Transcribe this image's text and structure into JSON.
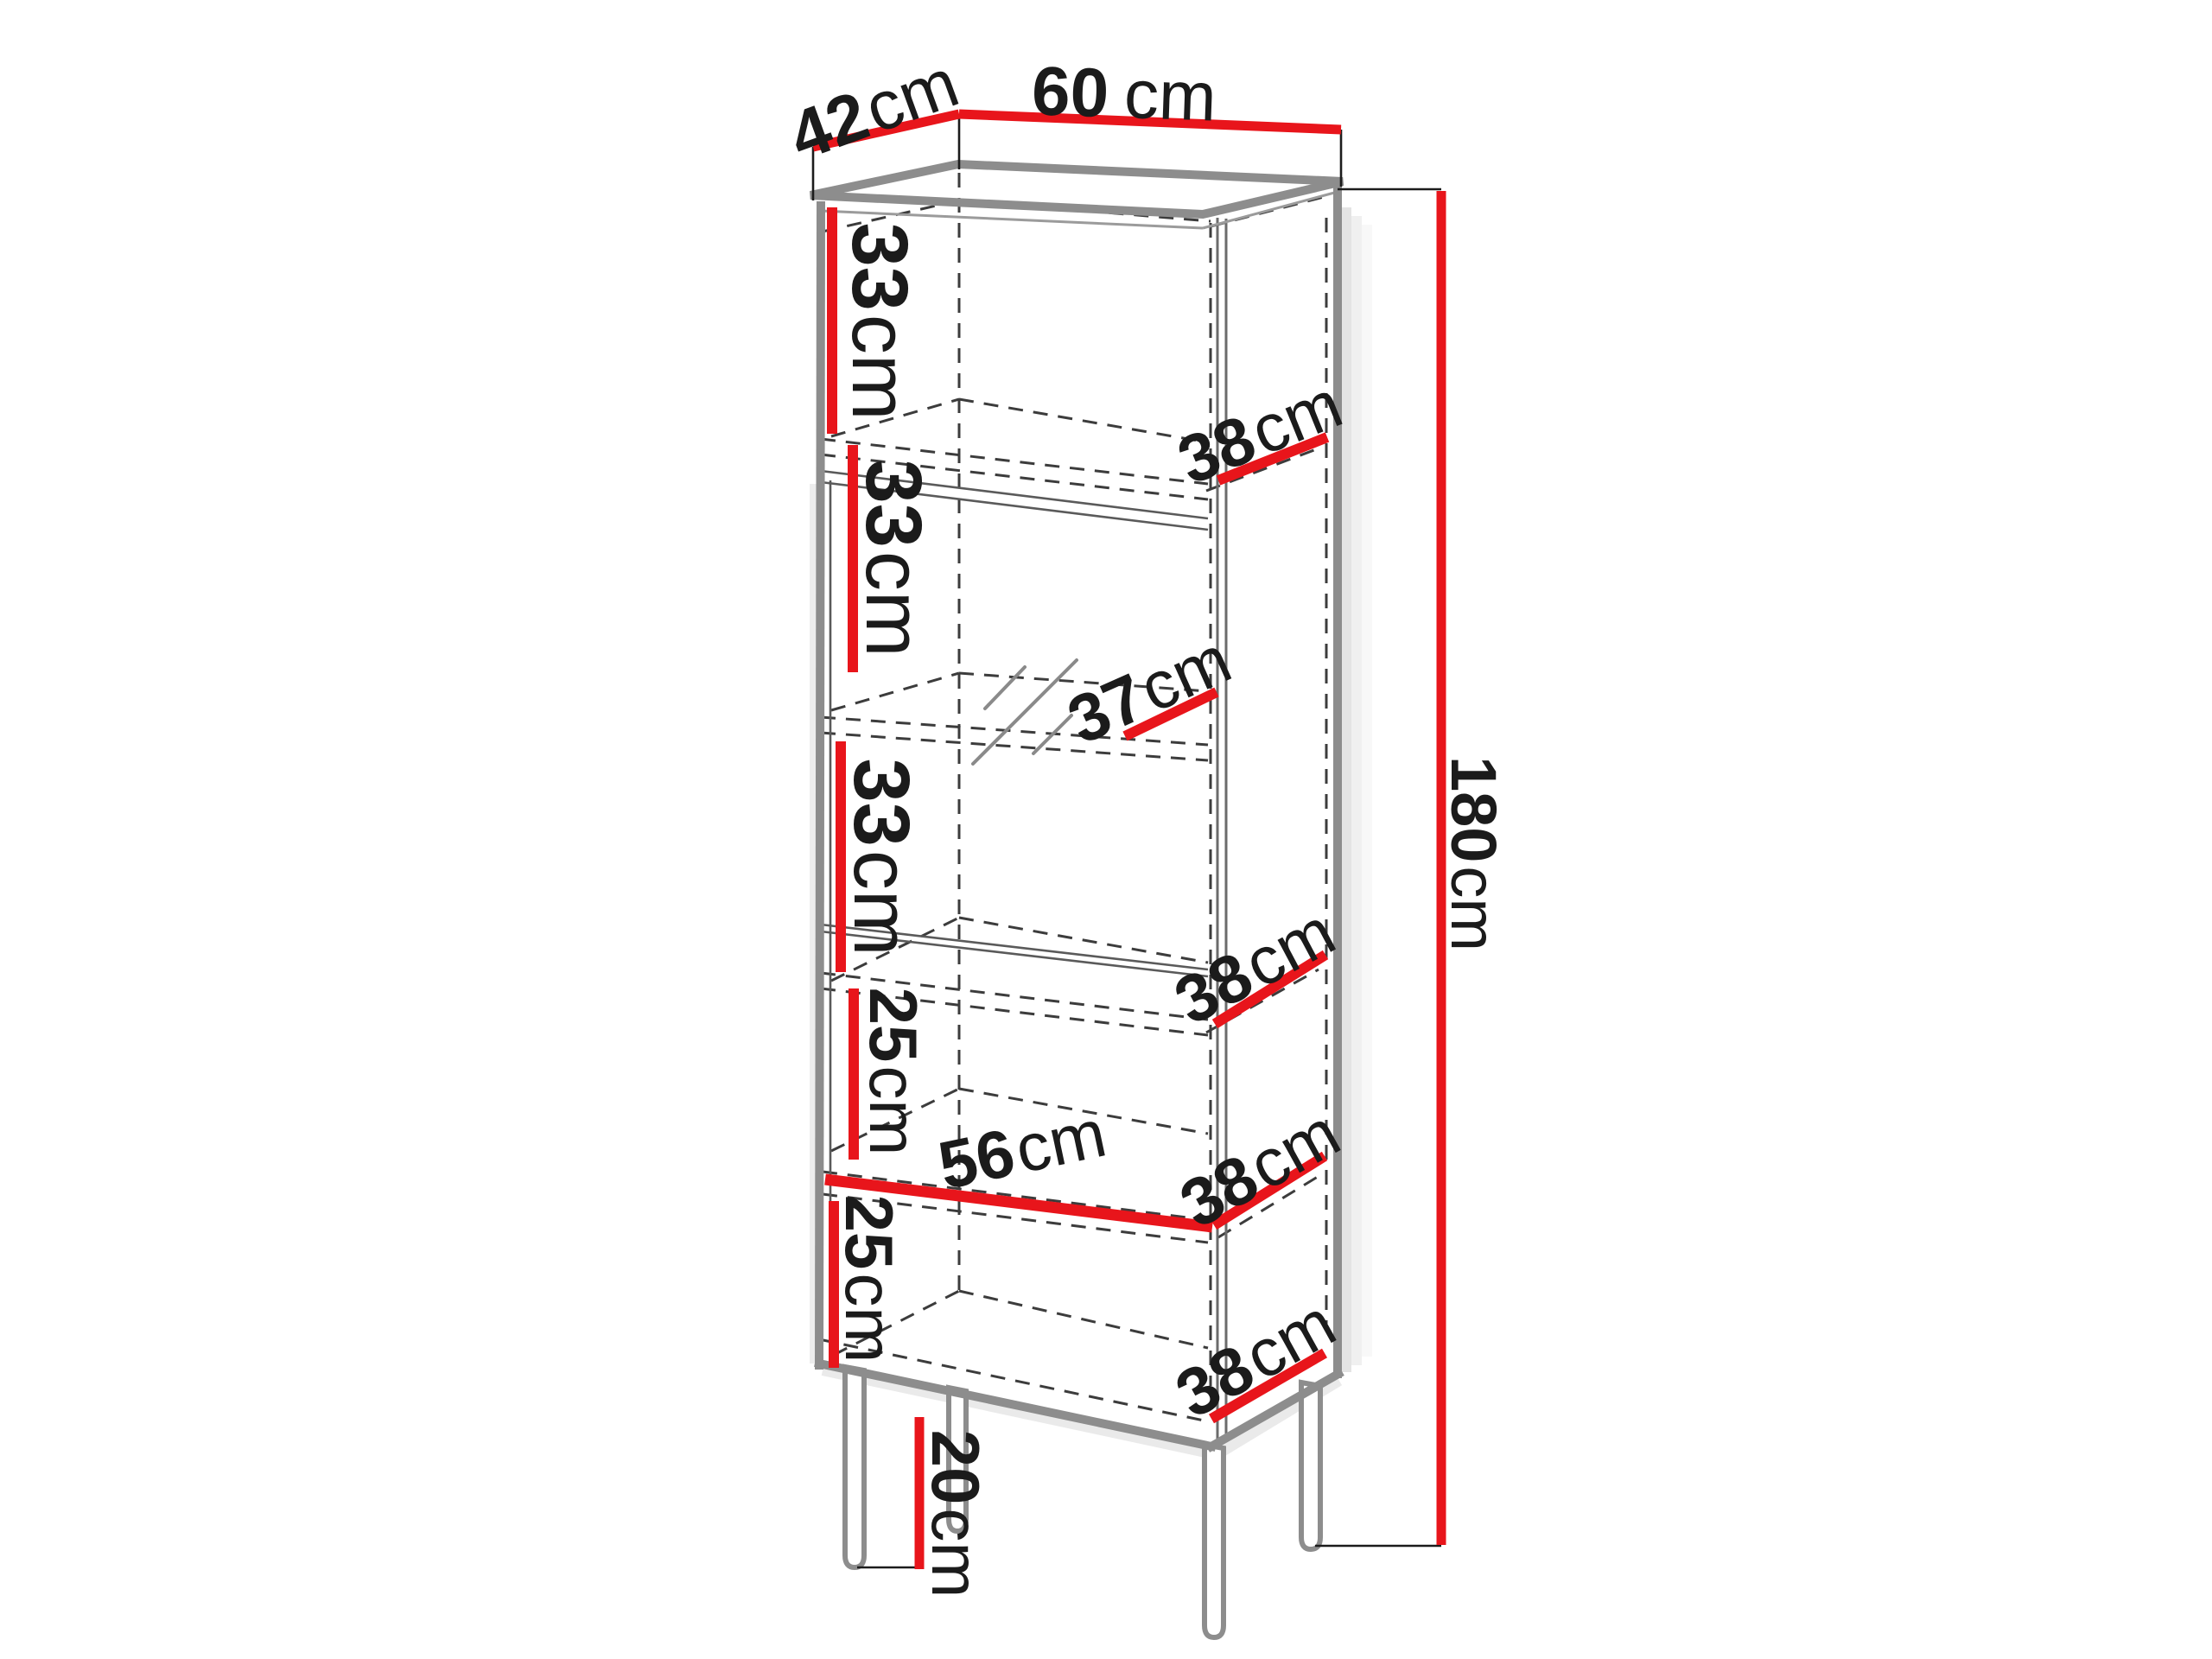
{
  "diagram": {
    "type": "furniture-dimension-diagram",
    "subject": "tall display cabinet (vitrine) with glass door, shelves and legs",
    "unit": "cm",
    "colors": {
      "dimension_red": "#e8151b",
      "edge_gray": "#8d8d8d",
      "line_dark": "#1c1c1c"
    },
    "labels": {
      "top_depth": {
        "num": "42",
        "unit": "cm"
      },
      "top_width": {
        "num": "60",
        "unit": "cm"
      },
      "height": {
        "num": "180",
        "unit": "cm"
      },
      "leg_height": {
        "num": "20",
        "unit": "cm"
      },
      "inner_width": {
        "num": "56",
        "unit": "cm"
      },
      "glass_shelf_depth": {
        "num": "37",
        "unit": "cm"
      },
      "sections": [
        {
          "height": {
            "num": "33",
            "unit": "cm"
          }
        },
        {
          "height": {
            "num": "33",
            "unit": "cm"
          }
        },
        {
          "height": {
            "num": "33",
            "unit": "cm"
          }
        },
        {
          "height": {
            "num": "25",
            "unit": "cm"
          }
        },
        {
          "height": {
            "num": "25",
            "unit": "cm"
          }
        }
      ],
      "shelf_depths": [
        {
          "num": "38",
          "unit": "cm"
        },
        {
          "num": "38",
          "unit": "cm"
        },
        {
          "num": "38",
          "unit": "cm"
        },
        {
          "num": "38",
          "unit": "cm"
        }
      ]
    },
    "dimensions_cm": {
      "overall_width": 60,
      "overall_depth": 42,
      "overall_height": 180,
      "leg_height": 20,
      "interior_clear_width": 56,
      "glass_shelf_depth": 37,
      "section_heights_top_to_bottom": [
        33,
        33,
        33,
        25,
        25
      ],
      "shelf_depths": [
        38,
        38,
        38,
        38
      ]
    }
  }
}
